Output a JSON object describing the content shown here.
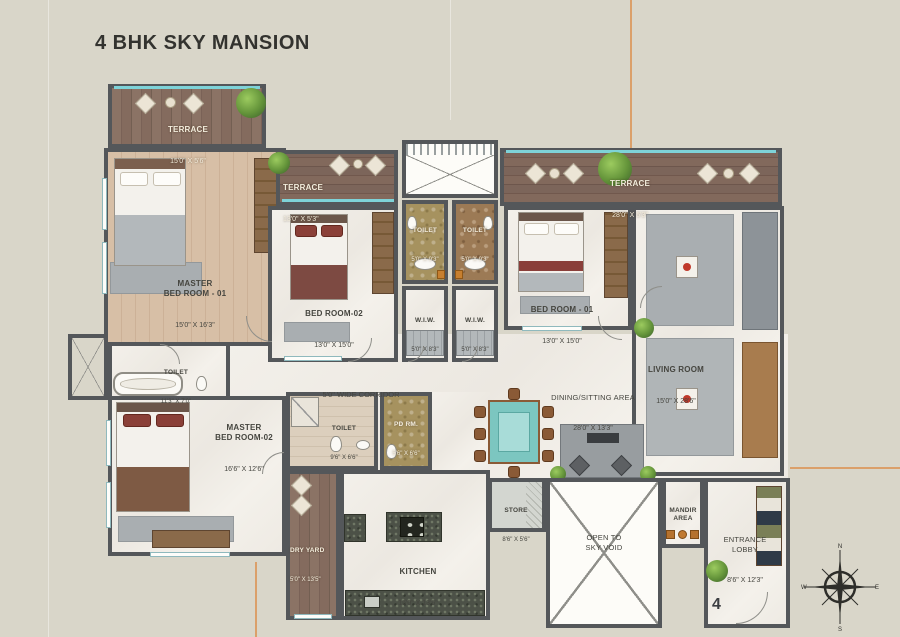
{
  "title": "4 BHK SKY MANSION",
  "unit_number": "4",
  "compass": {
    "n": "N",
    "s": "S",
    "e": "E",
    "w": "W"
  },
  "colors": {
    "background": "#d9d6c9",
    "wall": "#54575a",
    "terrace_wood": "#82695a",
    "bedroom_wood": "#cfb49b",
    "marble": "#f1eee9",
    "teal_rail": "#7ed3d8",
    "khaki_marble": "#a6925f",
    "brown_marble": "#9c7a55",
    "accent_red": "#8a4038",
    "plant_green": "#5d8f33",
    "guide_orange": "#dba06a"
  },
  "rooms": {
    "terrace_tl": {
      "name": "TERRACE",
      "dims": "15'0\" X 5'6\""
    },
    "master_br_01": {
      "name": "MASTER\nBED ROOM - 01",
      "dims": "15'0\" X 16'3\""
    },
    "terrace_mid": {
      "name": "TERRACE",
      "dims": "13'0\" X 5'3\""
    },
    "bed_room_02": {
      "name": "BED ROOM-02",
      "dims": "13'0\" X 15'0\""
    },
    "toilet_a": {
      "name": "TOILET",
      "dims": "5'0\" X 9'3\""
    },
    "toilet_b": {
      "name": "TOILET",
      "dims": "5'0\" X 9'3\""
    },
    "wiw_a": {
      "name": "W.I.W.",
      "dims": "5'0\" X 8'3\""
    },
    "wiw_b": {
      "name": "W.I.W.",
      "dims": "5'0\" X 8'3\""
    },
    "terrace_tr": {
      "name": "TERRACE",
      "dims": "28'0\" X 5'3\""
    },
    "bed_room_01": {
      "name": "BED ROOM - 01",
      "dims": "13'0\" X 15'0\""
    },
    "living_room": {
      "name": "LIVING ROOM",
      "dims": "15'0\" X 28'6\""
    },
    "toilet_m1": {
      "name": "TOILET",
      "dims": "11'3\" X 7'0\""
    },
    "corridor": {
      "name": "5'0\" WIDE CORRIDOR"
    },
    "dining": {
      "name": "DINING/SITTING AREA",
      "dims": "28'0\" X 13'3\""
    },
    "master_br_02": {
      "name": "MASTER\nBED ROOM-02",
      "dims": "16'6\" X 12'6\""
    },
    "toilet_m2": {
      "name": "TOILET",
      "dims": "9'6\" X 6'6\""
    },
    "pd_rm": {
      "name": "PD RM.",
      "dims": "5'6\" X 6'6\""
    },
    "dry_yard": {
      "name": "DRY YARD",
      "dims": "5'0\" X 13'5\""
    },
    "kitchen": {
      "name": "KITCHEN",
      "dims": "15'0\" X 13'6\""
    },
    "store": {
      "name": "STORE",
      "dims": "8'6\" X 5'6\""
    },
    "open_sky": {
      "name": "OPEN TO\nSKY VOID"
    },
    "mandir": {
      "name": "MANDIR\nAREA"
    },
    "entrance": {
      "name": "ENTRANCE\nLOBBY",
      "dims": "8'6\" X 12'3\""
    }
  }
}
